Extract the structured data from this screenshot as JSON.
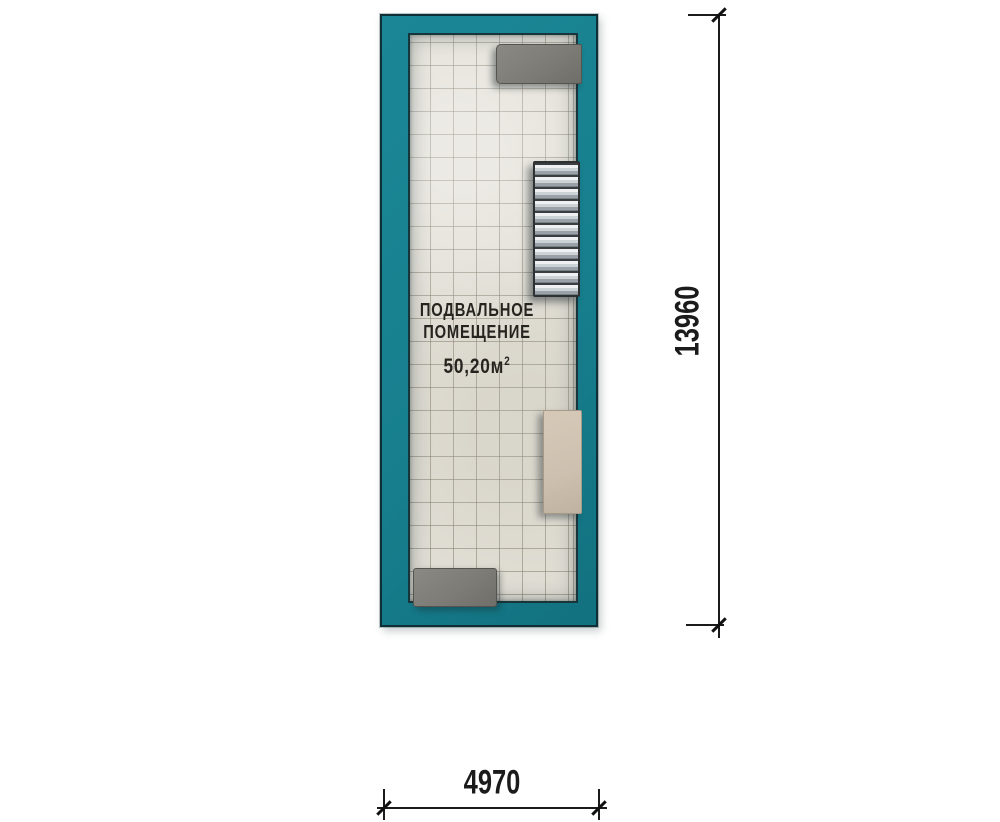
{
  "plan": {
    "room": {
      "name_line1": "ПОДВАЛЬНОЕ",
      "name_line2": "ПОМЕЩЕНИЕ",
      "area_value": "50,20",
      "area_unit": "м",
      "area_exponent": "2"
    },
    "dimensions": {
      "vertical_mm": "13960",
      "horizontal_mm": "4970"
    },
    "colors": {
      "wall_teal": "#177f8e",
      "wall_outline": "#0f2f36",
      "floor_tile": "#e2dfd6",
      "tile_grout": "#7d7868",
      "platform_gray": "#7d7c77",
      "counter_beige": "#cdc0af",
      "stair_tread_light": "#eef0f2",
      "stair_tread_dark": "#9aa1a8",
      "dimension_ink": "#1b1b1b"
    }
  }
}
